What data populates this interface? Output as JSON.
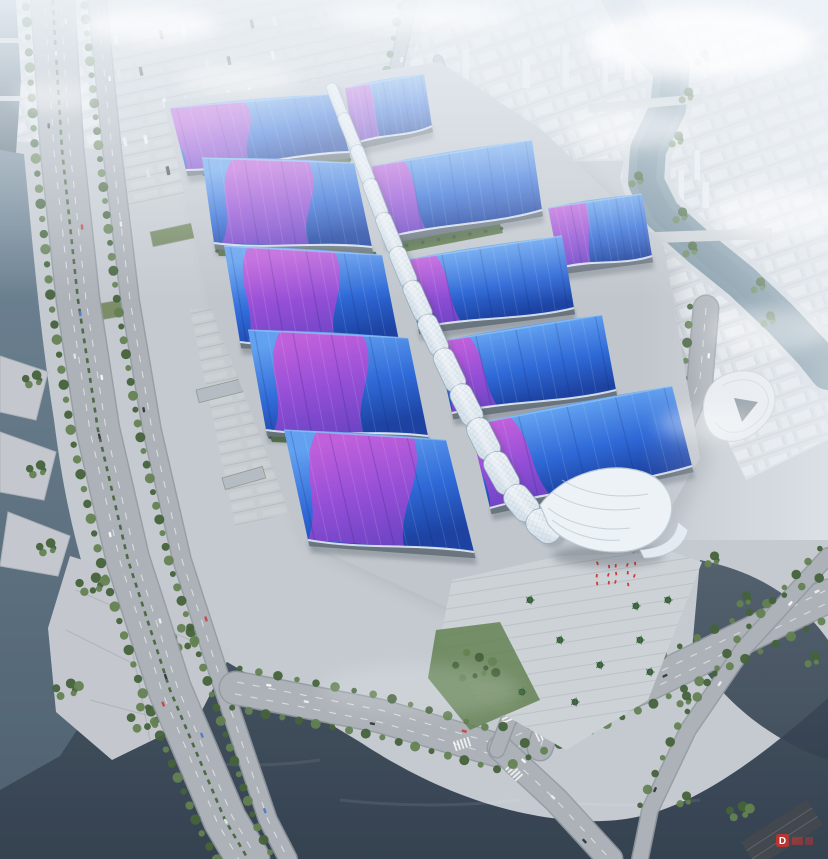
{
  "meta": {
    "description": "Aerial perspective rendering of a large exhibition and convention center: rows of wavy blue exhibition-hall roofs with purple ribbon patterns flank a sinuous white central pedestrian spine ending in a white shell canopy over an entrance plaza; the complex is surrounded by parking lots, tree-lined expressways, canals and rivers, and a hazy white city skyline."
  },
  "watermark": {
    "text": "D",
    "color": "#c9342e"
  },
  "palette": {
    "base": "#c3c9ce",
    "cityFill": "#d6dbdf",
    "blockLight": "#e9edf0",
    "blockShade": "#ccd2d8",
    "towerFill": "#eef1f4",
    "towerShade": "#d4dade",
    "waterLeftTop": "#6b8292",
    "waterLeftBot": "#475a68",
    "waterBottomTop": "#3e4e5c",
    "waterBottomBot": "#2c3947",
    "riverTop": "#8fa6b2",
    "riverBot": "#6a8695",
    "road": "#a9afb4",
    "roadEdge": "#8e969c",
    "laneMark": "#f2f5f7",
    "ground": "#bfc5ca",
    "plaza": "#ccd1d5",
    "step": "#b7bdc3",
    "parkLand": "#c2c7cc",
    "green": "#5d7c4a",
    "greenDark": "#3c5c30",
    "greenStrip": "#55743f",
    "roofLight": "#5b9df0",
    "roofMid": "#2563d6",
    "roofDeep": "#12399c",
    "ribbonTop": "#c653d8",
    "ribbonMid": "#9a44d4",
    "ribbonDeep": "#6f3cc6",
    "spineLight": "#f4f8fa",
    "spineShade": "#cfdde6",
    "spineEdge": "#8fa5b6",
    "facade": "#5f6a74",
    "shadow": "#2e3842",
    "shell": "#eef3f6",
    "shellEdge": "#b9c8d2",
    "haze": "#eef4f8",
    "red": "#c9342e",
    "buildingDark": "#3a4046"
  }
}
